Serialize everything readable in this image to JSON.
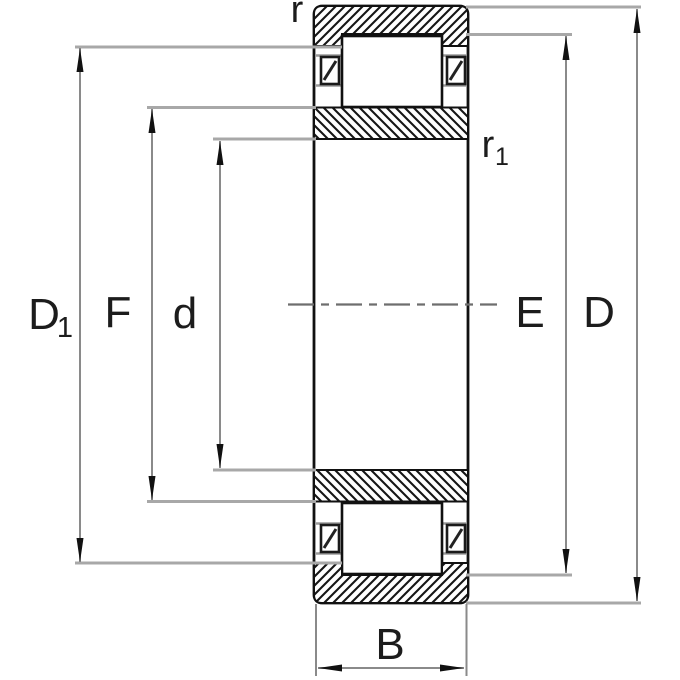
{
  "diagram": {
    "type": "bearing-cross-section",
    "colors": {
      "background": "#ffffff",
      "outline": "#111111",
      "hatch": "#151515",
      "extension_line": "#a8a8a8",
      "dimension_line": "#8a8a8a",
      "arrow": "#111111",
      "centerline": "#6e6e6e",
      "label": "#1c1c1c"
    },
    "labels": {
      "r_outer": "r",
      "r_inner_main": "r",
      "r_inner_sub": "1",
      "D1_main": "D",
      "D1_sub": "1",
      "F": "F",
      "d": "d",
      "E": "E",
      "D": "D",
      "B": "B"
    }
  }
}
